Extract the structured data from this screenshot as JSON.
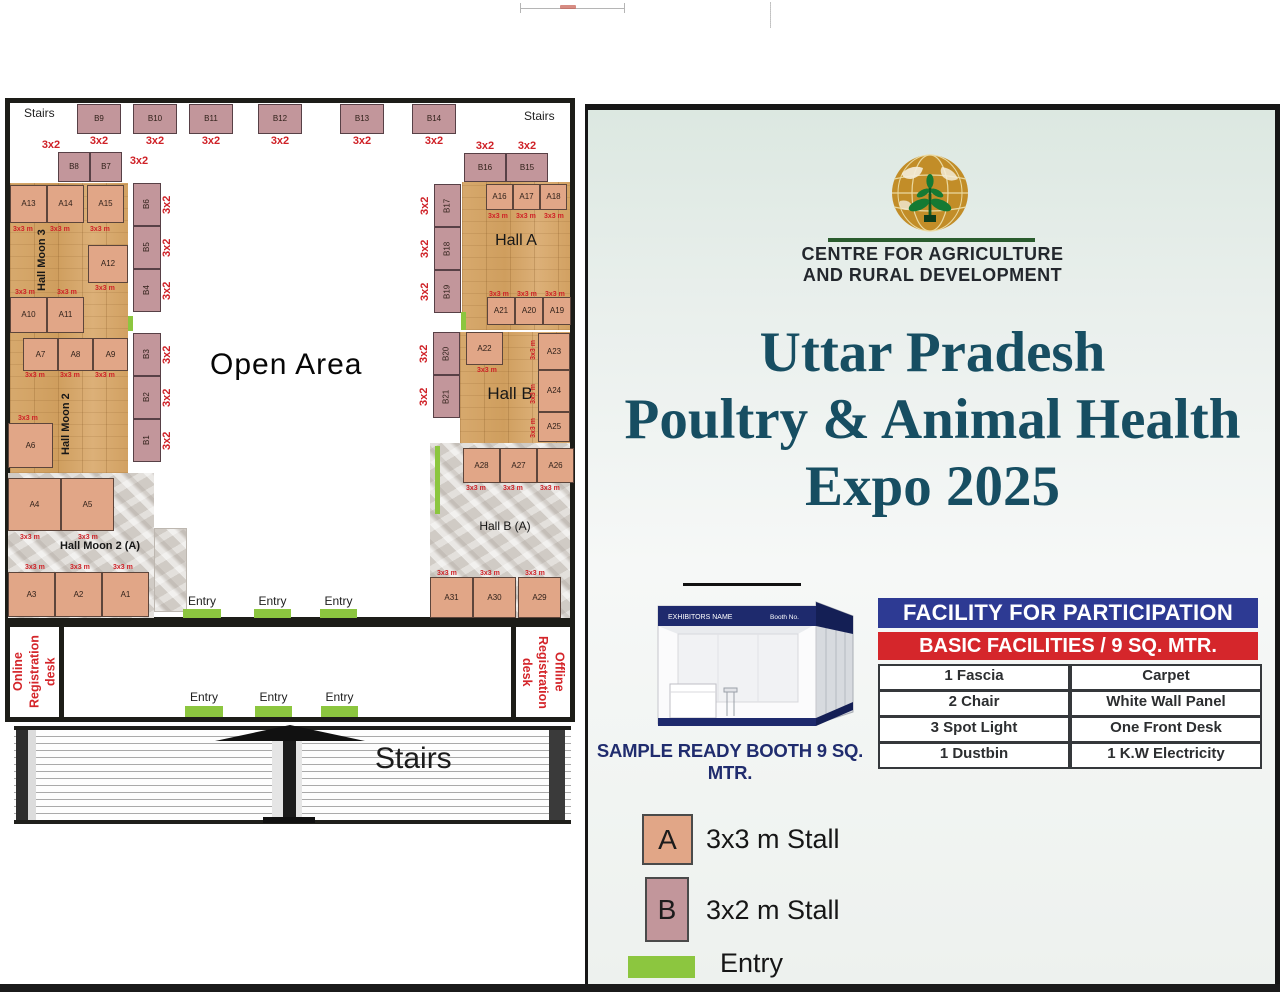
{
  "plan": {
    "stairs": "Stairs",
    "open_area": "Open Area",
    "entry": "Entry",
    "online_desk": [
      "Online",
      "Registration desk"
    ],
    "offline_desk": [
      "Offline",
      "Registration desk"
    ],
    "dims": {
      "b": "3x2",
      "a": "3x3 m"
    },
    "halls": {
      "moon3": "Hall Moon 3",
      "moon2": "Hall Moon 2",
      "moon2a": "Hall Moon 2 (A)",
      "hall_a": "Hall A",
      "hall_b": "Hall B",
      "hall_ba": "Hall B (A)"
    },
    "b_top": [
      "B9",
      "B10",
      "B11",
      "B12",
      "B13",
      "B14"
    ],
    "b_pair": [
      "B8",
      "B7"
    ],
    "b_left1": [
      "B6",
      "B5",
      "B4"
    ],
    "b_left2": [
      "B3",
      "B2",
      "B1"
    ],
    "b_right_top": [
      "B16",
      "B15"
    ],
    "b_right_col": [
      "B17",
      "B18",
      "B19",
      "B20",
      "B21"
    ],
    "a_moon3": [
      "A13",
      "A14",
      "A15"
    ],
    "a_12": [
      "A12"
    ],
    "a_10_11": [
      "A10",
      "A11"
    ],
    "a_moon2": [
      "A7",
      "A8",
      "A9"
    ],
    "a_6": [
      "A6"
    ],
    "a_4_5": [
      "A4",
      "A5"
    ],
    "a_moon2a": [
      "A3",
      "A2",
      "A1"
    ],
    "a_hall_a_top": [
      "A16",
      "A17",
      "A18"
    ],
    "a_hall_a_bot": [
      "A21",
      "A20",
      "A19"
    ],
    "a_22": [
      "A22"
    ],
    "a_hall_b_right": [
      "A23",
      "A24",
      "A25"
    ],
    "a_hall_ba_top": [
      "A28",
      "A27",
      "A26"
    ],
    "a_hall_ba_bot": [
      "A31",
      "A30",
      "A29"
    ]
  },
  "side": {
    "org_line1": "CENTRE FOR AGRICULTURE",
    "org_line2": "AND RURAL DEVELOPMENT",
    "title_line1": "Uttar Pradesh",
    "title_line2": "Poultry & Animal Health",
    "title_line3": "Expo 2025",
    "booth": {
      "header_left": "EXHIBITORS NAME",
      "header_right": "Booth No.",
      "caption": "SAMPLE READY BOOTH 9 SQ. MTR."
    },
    "facility": {
      "header": "FACILITY FOR PARTICIPATION",
      "subheader": "BASIC FACILITIES / 9 SQ. MTR.",
      "rows": [
        [
          "1 Fascia",
          "Carpet"
        ],
        [
          "2 Chair",
          "White Wall Panel"
        ],
        [
          "3 Spot Light",
          "One Front Desk"
        ],
        [
          "1 Dustbin",
          "1 K.W Electricity"
        ]
      ]
    },
    "legend": {
      "a_letter": "A",
      "a_label": "3x3 m Stall",
      "b_letter": "B",
      "b_label": "3x2 m Stall",
      "entry_label": "Entry"
    }
  },
  "colors": {
    "a_stall": "#e1a687",
    "b_stall": "#c2969b",
    "entry_green": "#8cc63f",
    "dim_red": "#cf2127",
    "header_blue": "#2d3a93",
    "header_red": "#d5262b",
    "title_teal": "#174e62",
    "booth_navy": "#202c6e",
    "logo_gold": "#c28d28",
    "plant_green": "#157a33",
    "desk_red": "#d4252a"
  }
}
